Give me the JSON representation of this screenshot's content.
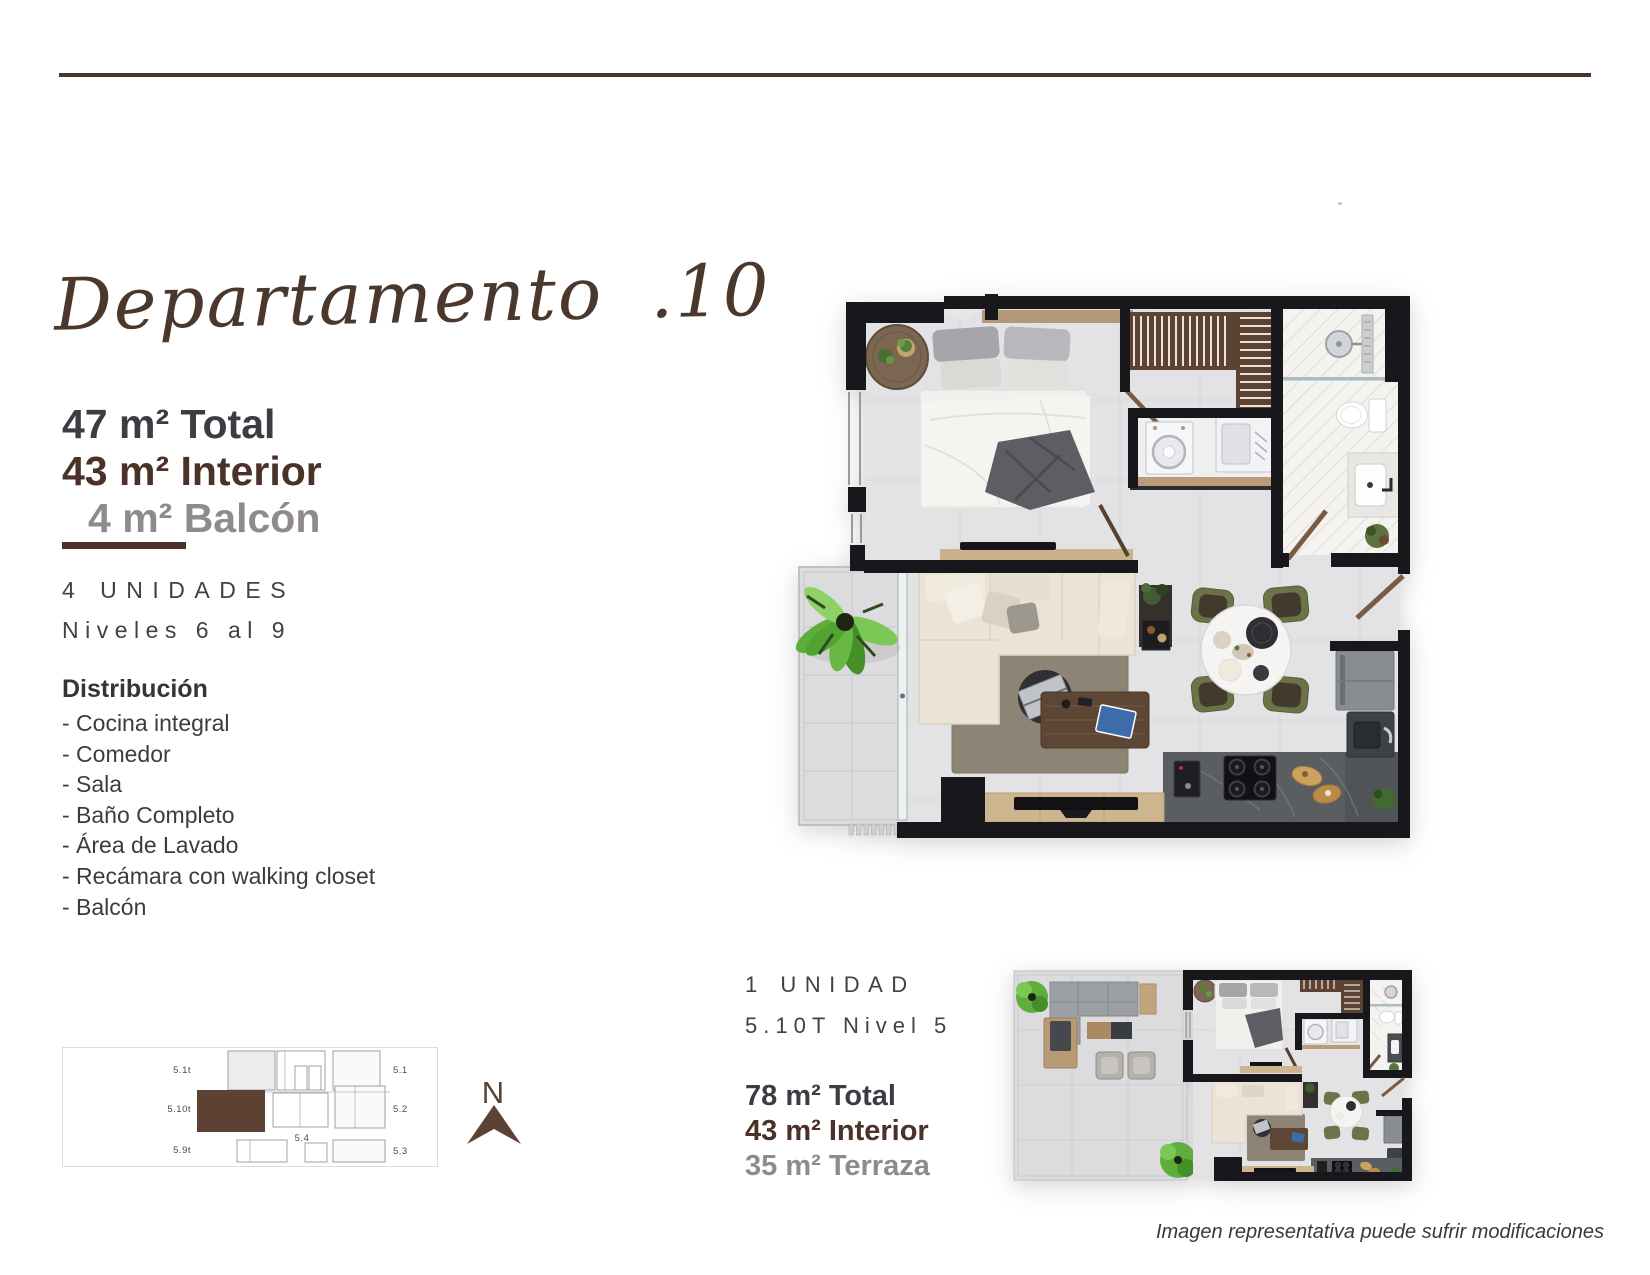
{
  "page": {
    "accent_rule_color": "#4a3527",
    "background": "#ffffff"
  },
  "title": {
    "script": "Departamento .10"
  },
  "unit_a": {
    "stats": [
      {
        "text": "47 m² Total",
        "color": "#3e3c43"
      },
      {
        "text": "43 m² Interior",
        "color": "#4a3228"
      },
      {
        "text": "4 m² Balcón",
        "color": "#8f8b8b"
      }
    ],
    "units": "4 UNIDADES",
    "levels": "Niveles 6 al 9",
    "distribution_title": "Distribución",
    "distribution_items": [
      "- Cocina integral",
      "- Comedor",
      "- Sala",
      "- Baño Completo",
      "- Área de Lavado",
      "- Recámara con walking closet",
      "- Balcón"
    ]
  },
  "unit_b": {
    "units": "1 UNIDAD",
    "levels": "5.10T Nivel 5",
    "stats": [
      {
        "text": "78 m² Total",
        "color": "#3e3c43"
      },
      {
        "text": "43 m² Interior",
        "color": "#4a3228"
      },
      {
        "text": "35 m² Terraza",
        "color": "#8f8b8b"
      }
    ]
  },
  "key_plan": {
    "highlight_color": "#5d4233",
    "labels": {
      "left_top": "5.1t",
      "left_mid": "5.10t",
      "left_bottom": "5.9t",
      "right_top": "5.1",
      "right_mid": "5.2",
      "right_bottom": "5.3",
      "center": "5.4"
    }
  },
  "compass": {
    "label": "N",
    "color": "#5b4334"
  },
  "footer": {
    "disclaimer": "Imagen representativa puede sufrir modificaciones"
  }
}
